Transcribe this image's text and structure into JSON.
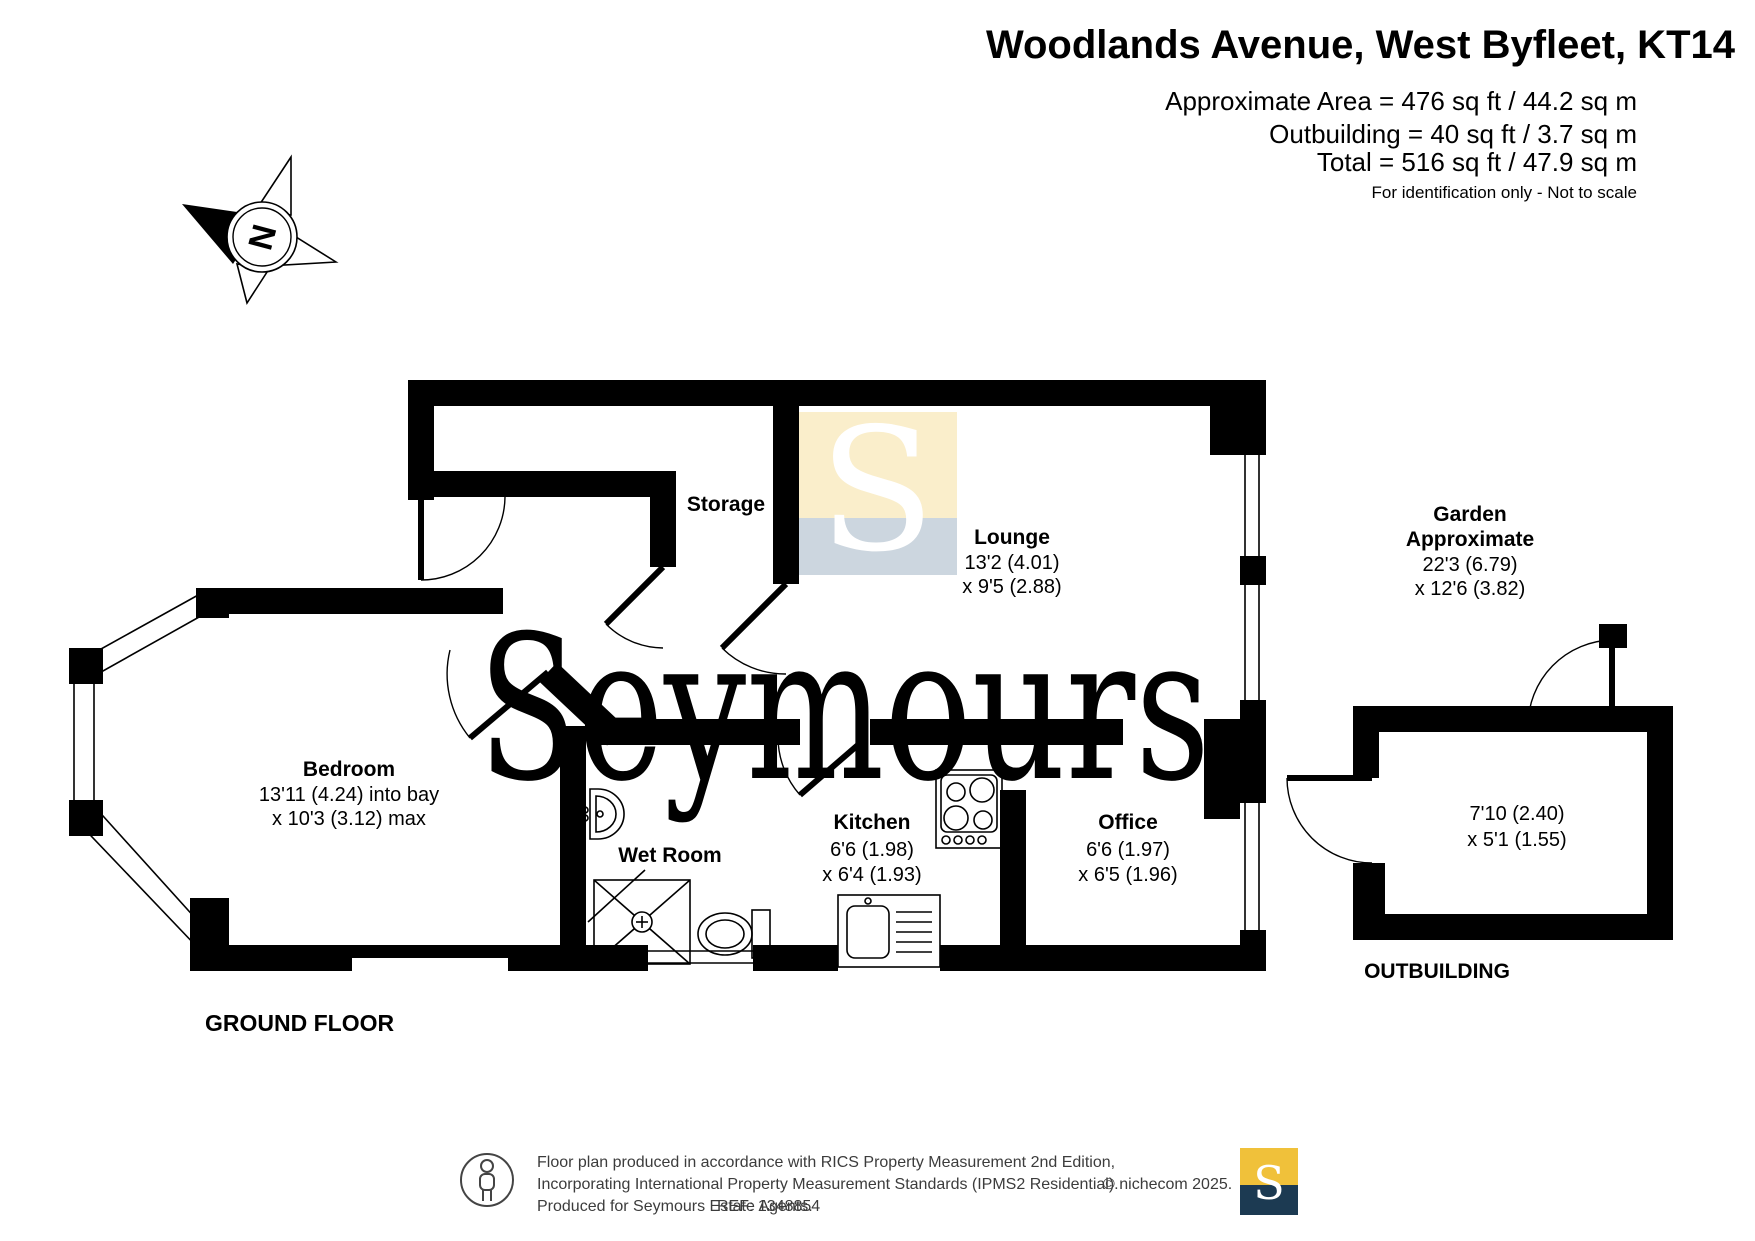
{
  "header": {
    "title": "Woodlands Avenue, West Byfleet, KT14",
    "area_lines": [
      "Approximate Area = 476 sq ft / 44.2 sq m",
      "Outbuilding = 40 sq ft / 3.7 sq m",
      "Total = 516 sq ft / 47.9 sq m"
    ],
    "disclaimer": "For identification only - Not to scale"
  },
  "compass": {
    "north_label": "N"
  },
  "floor_labels": {
    "ground": "GROUND FLOOR",
    "outbuilding": "OUTBUILDING"
  },
  "rooms": {
    "storage": {
      "name": "Storage"
    },
    "lounge": {
      "name": "Lounge",
      "dims": [
        "13'2 (4.01)",
        "x 9'5 (2.88)"
      ]
    },
    "bedroom": {
      "name": "Bedroom",
      "dims": [
        "13'11 (4.24) into bay",
        "x 10'3 (3.12) max"
      ]
    },
    "wet_room": {
      "name": "Wet Room"
    },
    "kitchen": {
      "name": "Kitchen",
      "dims": [
        "6'6 (1.98)",
        "x 6'4 (1.93)"
      ]
    },
    "office": {
      "name": "Office",
      "dims": [
        "6'6 (1.97)",
        "x 6'5 (1.96)"
      ]
    },
    "garden": {
      "name": "Garden",
      "qualifier": "Approximate",
      "dims": [
        "22'3 (6.79)",
        "x 12'6 (3.82)"
      ]
    },
    "outbuilding": {
      "dims": [
        "7'10 (2.40)",
        "x 5'1 (1.55)"
      ]
    }
  },
  "watermark": {
    "letter": "S",
    "text": "Seymours",
    "square_yellow": "#faeecb",
    "square_blue": "#ccd6df",
    "text_color": "#ccd4dc"
  },
  "footer": {
    "line1": "Floor plan produced in accordance with RICS Property Measurement 2nd Edition,",
    "line2": "Incorporating International Property Measurement Standards (IPMS2 Residential).",
    "line3": "Produced for Seymours Estate Agents.",
    "ref": "REF: 1348854",
    "copyright": "© nichecom 2025.",
    "logo_letter": "S",
    "logo_gold": "#f0c13a",
    "logo_navy": "#1c3a52"
  }
}
